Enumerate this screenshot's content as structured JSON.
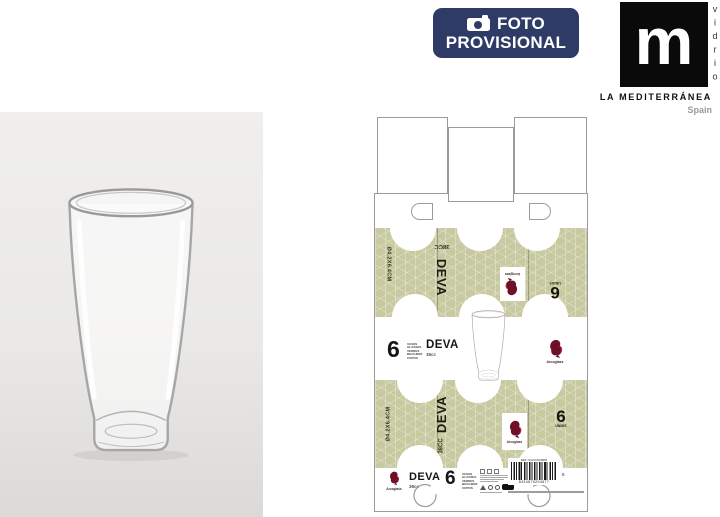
{
  "badge": {
    "line1": "FOTO",
    "line2": "PROVISIONAL"
  },
  "brand": {
    "logo_letter": "m",
    "vertical_text": "vidrio",
    "name": "LA MEDITERRÁNEA",
    "country": "Spain"
  },
  "product": {
    "name": "DEVA",
    "capacity": "38cc",
    "capacity_upper": "38CC",
    "units": "6",
    "units_label": "UNIDS",
    "dimensions": "Ø4.2X6.4CM",
    "maker": "Arcoglass",
    "unit_words": [
      "VASOS",
      "GLASSES",
      "VERRES",
      "BICCHIERI",
      "COPOS"
    ]
  },
  "barcode": {
    "ref": "REF: 5110C00JB04",
    "ean": "8434679204677",
    "side_digit": "5"
  },
  "colors": {
    "badge_bg": "#2d3b66",
    "green": "#c7c9a0",
    "maroon": "#6d1028",
    "red": "#c1203a",
    "dieline": "#9b9b9b"
  }
}
